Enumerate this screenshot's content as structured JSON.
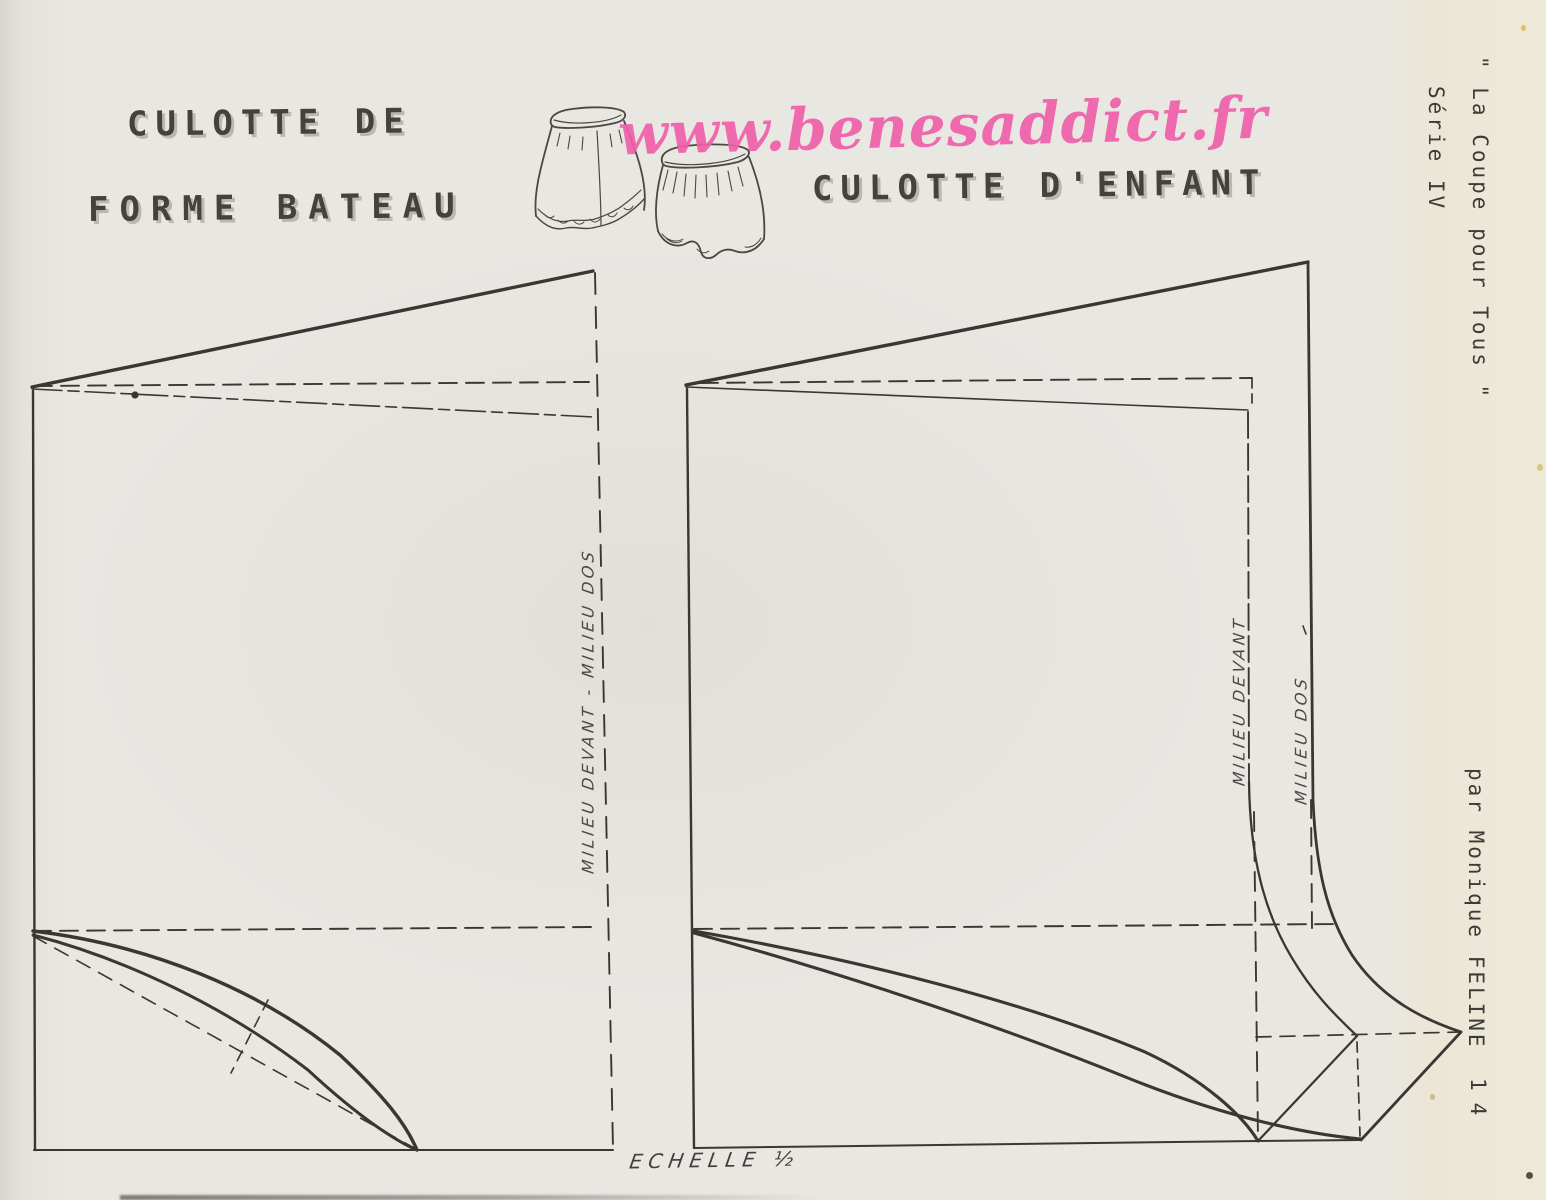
{
  "page": {
    "watermark": "www.benesaddict.fr",
    "collection_title": "\" La Coupe pour Tous \"",
    "series": "Série IV",
    "author": "par Monique FELINE",
    "page_number": "14",
    "scale_label": "ECHELLE ½"
  },
  "left_pattern": {
    "title_line1": "CULOTTE DE",
    "title_line2": "FORME BATEAU",
    "center_line_label": "MILIEU DEVANT - MILIEU DOS"
  },
  "right_pattern": {
    "title": "CULOTTE D'ENFANT",
    "center_front_label": "MILIEU DEVANT",
    "center_back_label": "MILIEU DOS"
  },
  "colors": {
    "paper": "#e9e7e2",
    "ink": "#3a3733",
    "watermark_pink": "#ef5fa9",
    "right_margin_cream": "#eee9d8"
  }
}
